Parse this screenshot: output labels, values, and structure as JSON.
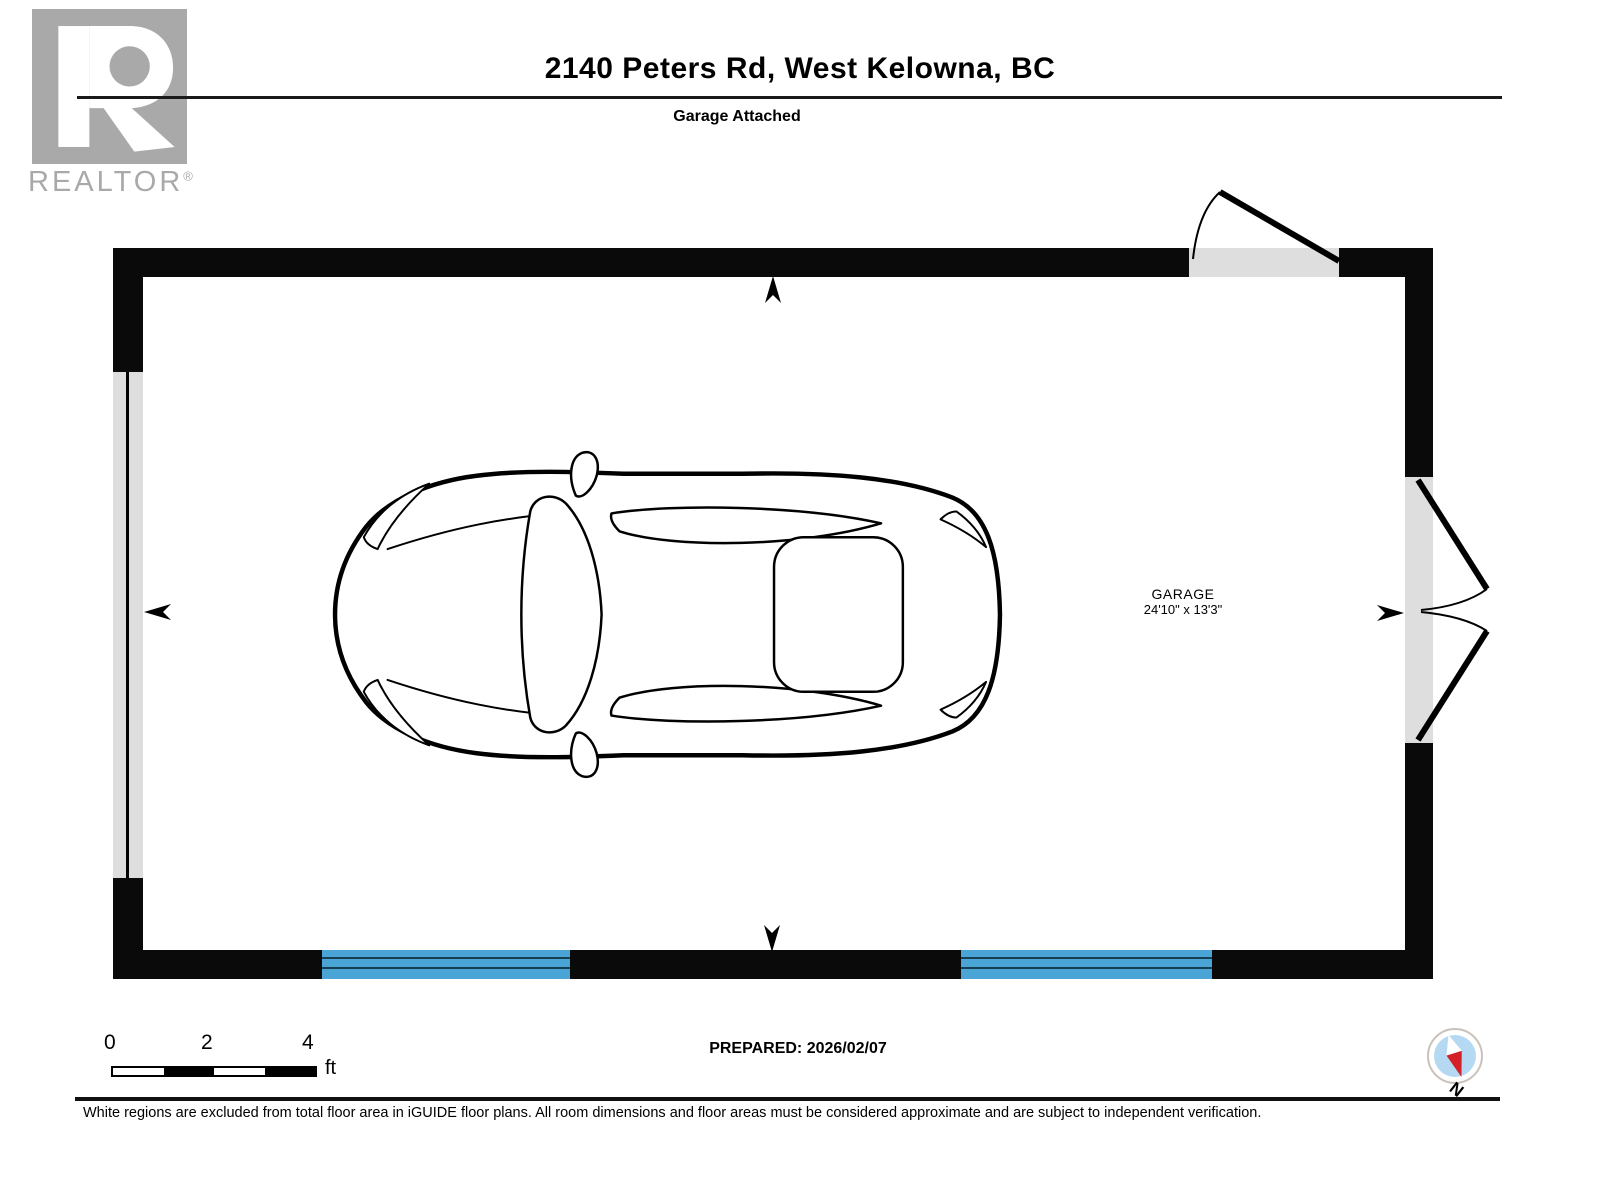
{
  "header": {
    "title": "2140 Peters Rd, West Kelowna, BC",
    "subtitle": "Garage Attached",
    "logo": {
      "brand": "REALTOR",
      "registered": "®"
    }
  },
  "plan": {
    "room": {
      "name": "GARAGE",
      "dimensions": "24'10\" x 13'3\""
    },
    "features": [
      "single-door-top-wall",
      "double-french-door-right-wall",
      "window-left-wall",
      "two-blue-windows-bottom-wall",
      "car-top-view"
    ],
    "colors": {
      "wall": "#0a0a0a",
      "opening_gray": "#dedede",
      "window_blue": "#4aa5d6",
      "pane_line": "#173f52",
      "logo_gray": "#a9a9a9",
      "compass_inner_blue": "#b5d9f2",
      "compass_red": "#d42027"
    }
  },
  "footer": {
    "scale": {
      "labels": [
        "0",
        "2",
        "4"
      ],
      "unit": "ft"
    },
    "prepared": "PREPARED: 2026/02/07",
    "compass_label": "N",
    "disclaimer": "White regions are excluded from total floor area in iGUIDE floor plans. All room dimensions and floor areas must be considered approximate and are subject to independent verification."
  }
}
